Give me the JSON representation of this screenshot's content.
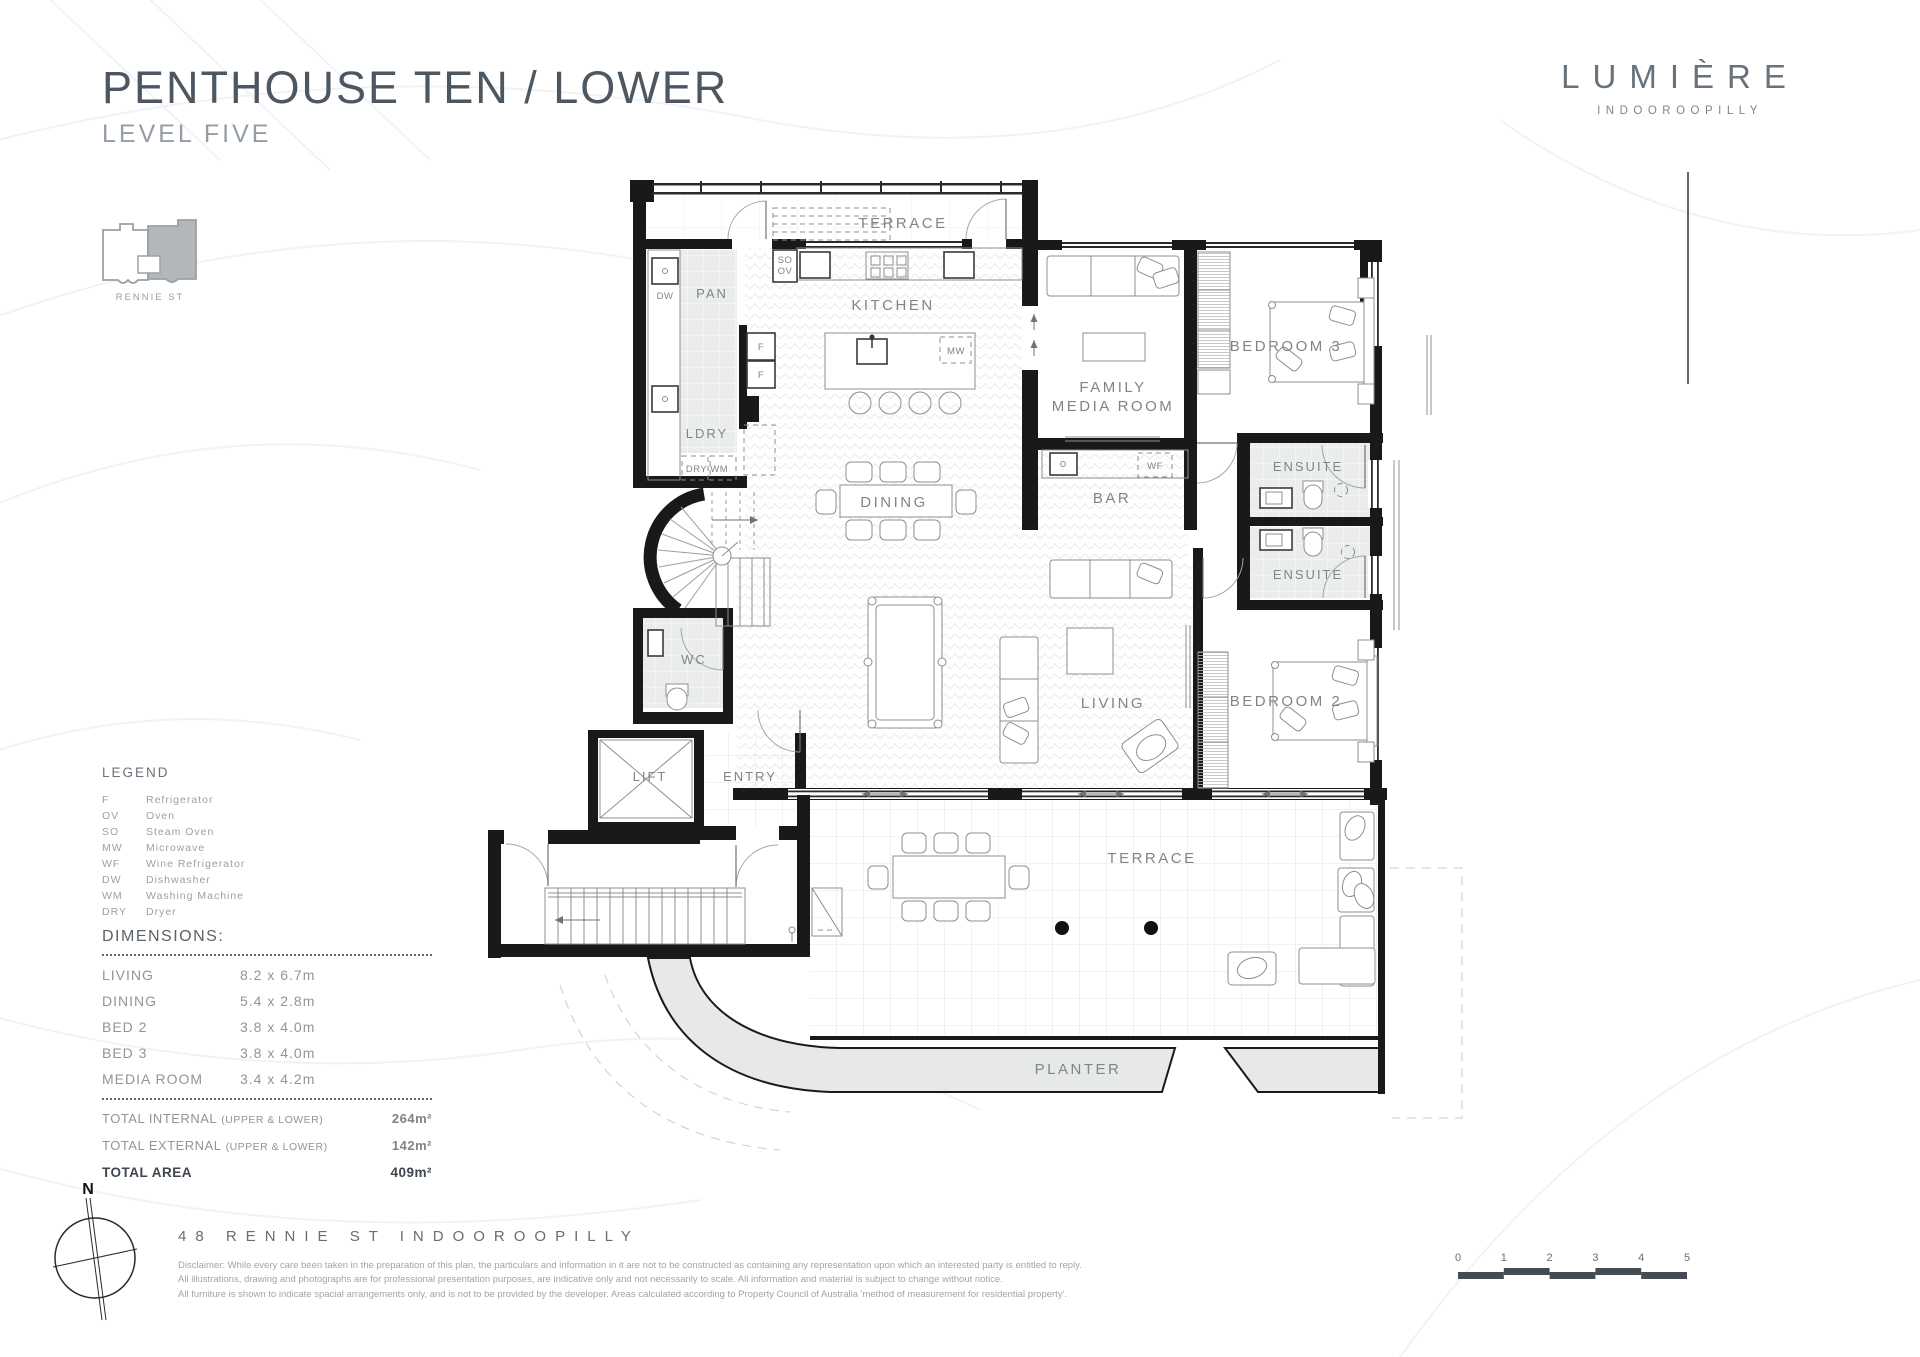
{
  "header": {
    "title": "PENTHOUSE TEN / LOWER",
    "subtitle": "LEVEL FIVE"
  },
  "brand": {
    "name": "LUMIÈRE",
    "location": "INDOOROOPILLY"
  },
  "locator": {
    "street": "RENNIE ST"
  },
  "legend": {
    "title": "LEGEND",
    "items": [
      {
        "abbr": "F",
        "label": "Refrigerator"
      },
      {
        "abbr": "OV",
        "label": "Oven"
      },
      {
        "abbr": "SO",
        "label": "Steam Oven"
      },
      {
        "abbr": "MW",
        "label": "Microwave"
      },
      {
        "abbr": "WF",
        "label": "Wine Refrigerator"
      },
      {
        "abbr": "DW",
        "label": "Dishwasher"
      },
      {
        "abbr": "WM",
        "label": "Washing Machine"
      },
      {
        "abbr": "DRY",
        "label": "Dryer"
      }
    ]
  },
  "dimensions": {
    "title": "DIMENSIONS:",
    "rows": [
      {
        "room": "LIVING",
        "size": "8.2 x 6.7m"
      },
      {
        "room": "DINING",
        "size": "5.4 x 2.8m"
      },
      {
        "room": "BED 2",
        "size": "3.8 x 4.0m"
      },
      {
        "room": "BED 3",
        "size": "3.8 x 4.0m"
      },
      {
        "room": "MEDIA ROOM",
        "size": "3.4 x 4.2m"
      }
    ],
    "totals": [
      {
        "label": "TOTAL INTERNAL",
        "sub": "(UPPER & LOWER)",
        "value": "264m²"
      },
      {
        "label": "TOTAL EXTERNAL",
        "sub": "(UPPER & LOWER)",
        "value": "142m²"
      },
      {
        "label": "TOTAL AREA",
        "sub": "",
        "value": "409m²"
      }
    ]
  },
  "plan": {
    "labels": {
      "terrace_top": "TERRACE",
      "terrace_bottom": "TERRACE",
      "planter": "PLANTER",
      "pan": "PAN",
      "so": "SO",
      "ov": "OV",
      "dw": "DW",
      "kitchen": "KITCHEN",
      "mw": "MW",
      "f": "F",
      "ldry": "LDRY",
      "dry_wm": "DRY  WM",
      "dining": "DINING",
      "family1": "FAMILY",
      "family2": "MEDIA ROOM",
      "bedroom3": "BEDROOM 3",
      "ensuite": "ENSUITE",
      "bar": "BAR",
      "wf": "WF",
      "wc": "WC",
      "living": "LIVING",
      "bedroom2": "BEDROOM 2",
      "lift": "LIFT",
      "entry": "ENTRY"
    }
  },
  "footer": {
    "compass": "N",
    "address": "48  RENNIE  ST  INDOOROOPILLY",
    "disclaimer": [
      "Disclaimer: While every care been taken in the preparation of this plan, the particulars and information in it are not to be constructed as containing any representation upon which an interested party is entitled to reply.",
      "All illustrations, drawing and photographs are for professional presentation purposes, are indicative only and not necessarily to scale. All information and material is subject to change without notice.",
      "All furniture is shown to indicate spacial arrangements only, and is not to be provided by the developer. Areas calculated according to Property Council of Australia 'method of measurement for residential property'."
    ]
  },
  "scalebar": {
    "ticks": [
      "0",
      "1",
      "2",
      "3",
      "4",
      "5"
    ]
  }
}
